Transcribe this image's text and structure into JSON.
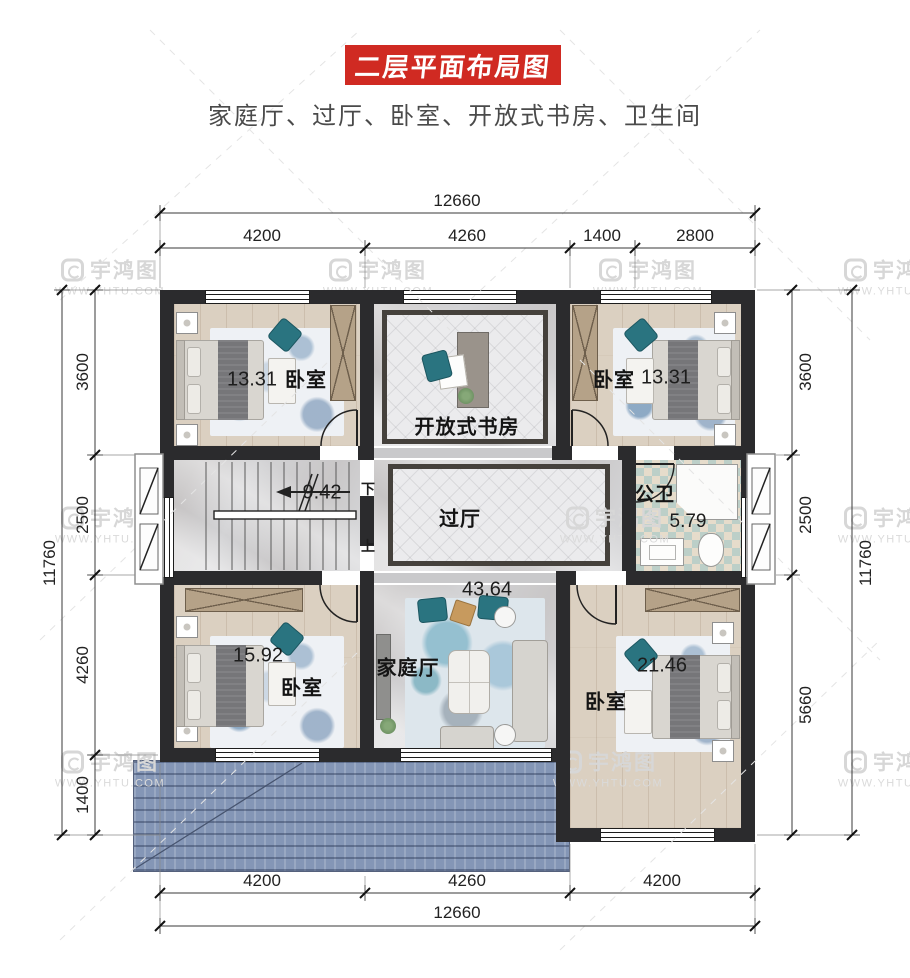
{
  "header": {
    "title": "二层平面布局图",
    "subtitle": "家庭厅、过厅、卧室、开放式书房、卫生间"
  },
  "watermark": {
    "brand": "宇鸿图",
    "url": "WWW.YHTU.COM"
  },
  "dimensions": {
    "top": {
      "overall": "12660",
      "segments": [
        "4200",
        "4260",
        "1400",
        "2800"
      ]
    },
    "bottom": {
      "overall": "12660",
      "segments": [
        "4200",
        "4260",
        "4200"
      ]
    },
    "left": {
      "overall": "11760",
      "segments": [
        "3600",
        "2500",
        "4260",
        "1400"
      ]
    },
    "right": {
      "overall": "11760",
      "segments": [
        "3600",
        "2500",
        "5660"
      ]
    }
  },
  "rooms": {
    "bedroom_top_left": {
      "label": "卧室",
      "area": "13.31"
    },
    "study": {
      "label": "开放式书房"
    },
    "bedroom_top_right": {
      "label": "卧室",
      "area": "13.31"
    },
    "stairs": {
      "area": "9.42",
      "down": "下",
      "up": "上"
    },
    "hallway": {
      "label": "过厅"
    },
    "bathroom": {
      "label": "公卫",
      "area": "5.79"
    },
    "family_hall": {
      "label": "家庭厅",
      "area": "43.64"
    },
    "bedroom_bottom_left": {
      "label": "卧室",
      "area": "15.92"
    },
    "bedroom_bottom_right": {
      "label": "卧室",
      "area": "21.46"
    }
  },
  "colors": {
    "banner": "#d02a22",
    "wall": "#2b2b2d",
    "roof": "#8496b6",
    "accent_teal": "#2a7480"
  }
}
